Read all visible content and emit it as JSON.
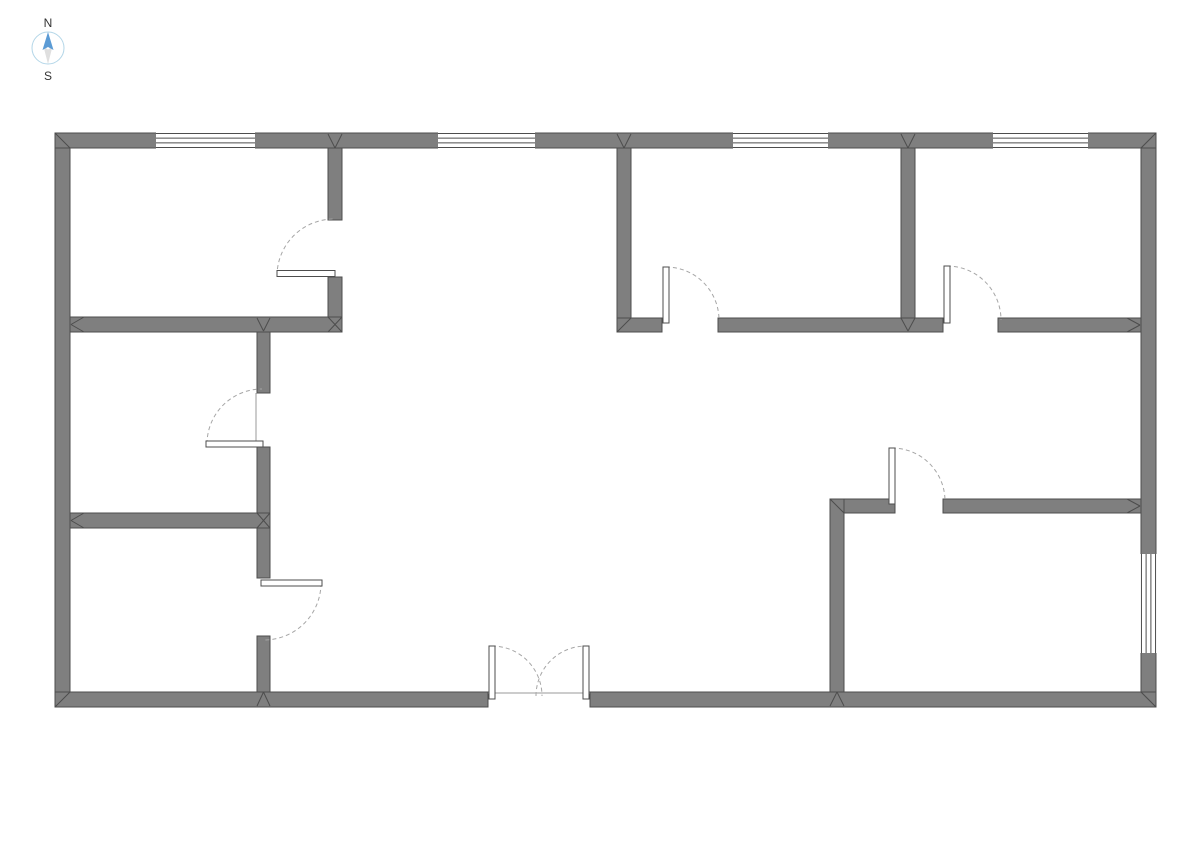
{
  "compass": {
    "north_label": "N",
    "south_label": "S",
    "ring_color": "#b3d6e8",
    "north_color": "#5b9bd5",
    "south_color": "#dfdfdf",
    "label_color": "#333333"
  },
  "plan": {
    "bg_color": "#ffffff",
    "wall_fill": "#7f7f7f",
    "wall_stroke": "#4d4d4d",
    "window_line": "#4d4d4d",
    "arc_color": "#a6a6a6",
    "leaf_stroke": "#4d4d4d",
    "frame_color": "#9a9a9a",
    "walls": [
      {
        "x": 55,
        "y": 133,
        "w": 1101,
        "h": 15
      },
      {
        "x": 55,
        "y": 692,
        "w": 433,
        "h": 15
      },
      {
        "x": 590,
        "y": 692,
        "w": 566,
        "h": 15
      },
      {
        "x": 55,
        "y": 148,
        "w": 15,
        "h": 544
      },
      {
        "x": 1141,
        "y": 148,
        "w": 15,
        "h": 544
      },
      {
        "x": 328,
        "y": 148,
        "w": 14,
        "h": 72
      },
      {
        "x": 328,
        "y": 277,
        "w": 14,
        "h": 55
      },
      {
        "x": 70,
        "y": 317,
        "w": 272,
        "h": 15
      },
      {
        "x": 257,
        "y": 332,
        "w": 13,
        "h": 61
      },
      {
        "x": 257,
        "y": 447,
        "w": 13,
        "h": 131
      },
      {
        "x": 257,
        "y": 636,
        "w": 13,
        "h": 56
      },
      {
        "x": 70,
        "y": 513,
        "w": 200,
        "h": 15
      },
      {
        "x": 617,
        "y": 318,
        "w": 45,
        "h": 14
      },
      {
        "x": 718,
        "y": 318,
        "w": 225,
        "h": 14
      },
      {
        "x": 998,
        "y": 318,
        "w": 143,
        "h": 14
      },
      {
        "x": 617,
        "y": 148,
        "w": 14,
        "h": 170
      },
      {
        "x": 901,
        "y": 148,
        "w": 14,
        "h": 170
      },
      {
        "x": 830,
        "y": 499,
        "w": 65,
        "h": 14
      },
      {
        "x": 943,
        "y": 499,
        "w": 198,
        "h": 14
      },
      {
        "x": 830,
        "y": 499,
        "w": 14,
        "h": 193
      }
    ],
    "windows": [
      {
        "x": 156,
        "y": 132.5,
        "w": 99,
        "h": 16,
        "o": "h"
      },
      {
        "x": 438,
        "y": 132.5,
        "w": 97,
        "h": 16,
        "o": "h"
      },
      {
        "x": 733,
        "y": 132.5,
        "w": 95,
        "h": 16,
        "o": "h"
      },
      {
        "x": 993,
        "y": 132.5,
        "w": 95,
        "h": 16,
        "o": "h"
      },
      {
        "x": 1140.5,
        "y": 554,
        "w": 16,
        "h": 99,
        "o": "v"
      }
    ],
    "doors": [
      {
        "leaf": {
          "x": 277,
          "y": 270.5,
          "w": 58,
          "h": 6
        },
        "arc": {
          "cx": 334,
          "cy": 276,
          "r": 57,
          "a0": 180,
          "a1": 270
        }
      },
      {
        "leaf": {
          "x": 206,
          "y": 441,
          "w": 57,
          "h": 6
        },
        "arc": {
          "cx": 262,
          "cy": 444,
          "r": 55,
          "a0": 180,
          "a1": 270
        }
      },
      {
        "leaf": {
          "x": 261,
          "y": 580,
          "w": 61,
          "h": 6
        },
        "arc": {
          "cx": 264,
          "cy": 583,
          "r": 57,
          "a0": 0,
          "a1": 90
        }
      },
      {
        "leaf": {
          "x": 663,
          "y": 267,
          "w": 6,
          "h": 56
        },
        "arc": {
          "cx": 666,
          "cy": 320,
          "r": 53,
          "a0": 270,
          "a1": 360
        }
      },
      {
        "leaf": {
          "x": 944,
          "y": 266,
          "w": 6,
          "h": 57
        },
        "arc": {
          "cx": 947,
          "cy": 320,
          "r": 54,
          "a0": 270,
          "a1": 360
        }
      },
      {
        "leaf": {
          "x": 889,
          "y": 448,
          "w": 6,
          "h": 56
        },
        "arc": {
          "cx": 892,
          "cy": 501,
          "r": 53,
          "a0": 270,
          "a1": 360
        }
      },
      {
        "leaf": {
          "x": 489,
          "y": 646,
          "w": 6,
          "h": 53
        },
        "arc": {
          "cx": 492,
          "cy": 696,
          "r": 50,
          "a0": 270,
          "a1": 360
        }
      },
      {
        "leaf": {
          "x": 583,
          "y": 646,
          "w": 6,
          "h": 53
        },
        "arc": {
          "cx": 586,
          "cy": 696,
          "r": 50,
          "a0": 180,
          "a1": 270
        }
      }
    ],
    "frame_lines": [
      {
        "x1": 488,
        "y1": 693,
        "x2": 590,
        "y2": 693
      },
      {
        "x1": 256,
        "y1": 393,
        "x2": 256,
        "y2": 444
      }
    ],
    "miters": [
      {
        "x1": 55,
        "y1": 133,
        "x2": 70,
        "y2": 148
      },
      {
        "x1": 1156,
        "y1": 133,
        "x2": 1141,
        "y2": 148
      },
      {
        "x1": 55,
        "y1": 707,
        "x2": 70,
        "y2": 692
      },
      {
        "x1": 1156,
        "y1": 707,
        "x2": 1141,
        "y2": 692
      },
      {
        "x1": 328,
        "y1": 134,
        "x2": 335,
        "y2": 148
      },
      {
        "x1": 342,
        "y1": 134,
        "x2": 335,
        "y2": 148
      },
      {
        "x1": 617,
        "y1": 134,
        "x2": 624,
        "y2": 148
      },
      {
        "x1": 631,
        "y1": 134,
        "x2": 624,
        "y2": 148
      },
      {
        "x1": 901,
        "y1": 134,
        "x2": 908,
        "y2": 148
      },
      {
        "x1": 915,
        "y1": 134,
        "x2": 908,
        "y2": 148
      },
      {
        "x1": 84,
        "y1": 317,
        "x2": 71,
        "y2": 324.5
      },
      {
        "x1": 84,
        "y1": 332,
        "x2": 71,
        "y2": 324.5
      },
      {
        "x1": 84,
        "y1": 513,
        "x2": 71,
        "y2": 520.5
      },
      {
        "x1": 84,
        "y1": 528,
        "x2": 71,
        "y2": 520.5
      },
      {
        "x1": 1127,
        "y1": 318,
        "x2": 1140,
        "y2": 325
      },
      {
        "x1": 1127,
        "y1": 332,
        "x2": 1140,
        "y2": 325
      },
      {
        "x1": 1127,
        "y1": 499,
        "x2": 1140,
        "y2": 506
      },
      {
        "x1": 1127,
        "y1": 513,
        "x2": 1140,
        "y2": 506
      },
      {
        "x1": 257,
        "y1": 706,
        "x2": 263.5,
        "y2": 692
      },
      {
        "x1": 270,
        "y1": 706,
        "x2": 263.5,
        "y2": 692
      },
      {
        "x1": 830,
        "y1": 706,
        "x2": 837,
        "y2": 692
      },
      {
        "x1": 844,
        "y1": 706,
        "x2": 837,
        "y2": 692
      },
      {
        "x1": 328,
        "y1": 317,
        "x2": 335,
        "y2": 324.5
      },
      {
        "x1": 342,
        "y1": 317,
        "x2": 335,
        "y2": 324.5
      },
      {
        "x1": 328,
        "y1": 332,
        "x2": 335,
        "y2": 324.5
      },
      {
        "x1": 342,
        "y1": 332,
        "x2": 335,
        "y2": 324.5
      },
      {
        "x1": 257,
        "y1": 318,
        "x2": 263.5,
        "y2": 331
      },
      {
        "x1": 270,
        "y1": 318,
        "x2": 263.5,
        "y2": 331
      },
      {
        "x1": 257,
        "y1": 513,
        "x2": 263.5,
        "y2": 520.5
      },
      {
        "x1": 257,
        "y1": 528,
        "x2": 263.5,
        "y2": 520.5
      },
      {
        "x1": 270,
        "y1": 513,
        "x2": 263.5,
        "y2": 520.5
      },
      {
        "x1": 270,
        "y1": 528,
        "x2": 263.5,
        "y2": 520.5
      },
      {
        "x1": 901,
        "y1": 318,
        "x2": 908,
        "y2": 331
      },
      {
        "x1": 915,
        "y1": 318,
        "x2": 908,
        "y2": 331
      },
      {
        "x1": 617,
        "y1": 332,
        "x2": 631,
        "y2": 318
      },
      {
        "x1": 830,
        "y1": 499,
        "x2": 844,
        "y2": 513
      }
    ]
  }
}
